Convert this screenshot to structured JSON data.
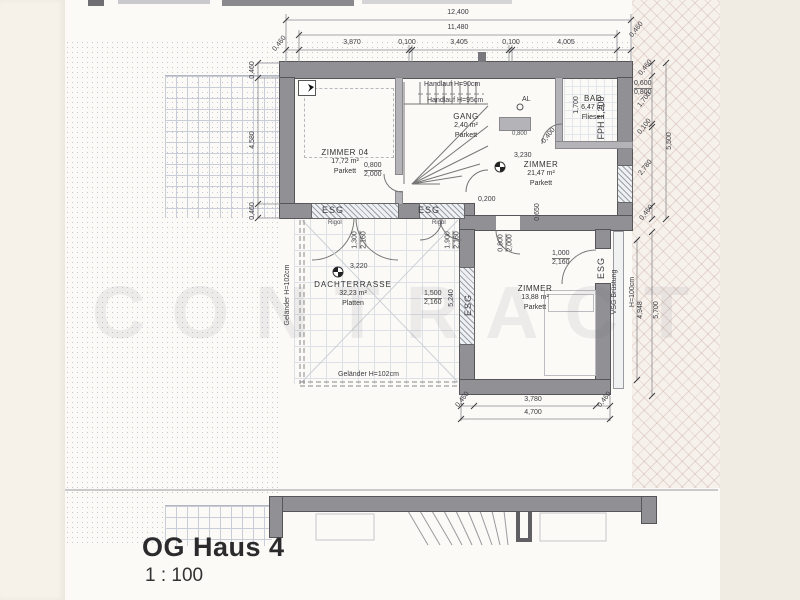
{
  "page": {
    "title": "OG Haus 4",
    "scale": "1 : 100"
  },
  "watermark": "CONTRACT",
  "rooms": {
    "zimmer04": {
      "name": "ZIMMER 04",
      "area": "17,72 m²",
      "floor": "Parkett"
    },
    "gang": {
      "name": "GANG",
      "area": "2,40 m²",
      "floor": "Parkett"
    },
    "bad": {
      "name": "BAD",
      "area": "6,47 m²",
      "floor": "Fliesen"
    },
    "zimmer_og": {
      "name": "ZIMMER",
      "area": "21,47 m²",
      "floor": "Parkett",
      "level": "3,230"
    },
    "zimmer_sued": {
      "name": "ZIMMER",
      "area": "13,88 m²",
      "floor": "Parkett"
    },
    "dachterrasse": {
      "name": "DACHTERRASSE",
      "area": "32,23 m²",
      "floor": "Platten",
      "level": "3,220"
    }
  },
  "stairs": {
    "handlauf_1": "Handlauf H=90cm",
    "handlauf_2": "Handlauf H=95cm"
  },
  "railings": {
    "gelaender_left": "Geländer H=102cm",
    "gelaender_bottom": "Geländer H=102cm",
    "vsg_line1": "VSG Brüstung",
    "vsg_line2": "H=100cm",
    "fph": "FPH 1,200"
  },
  "glass": {
    "esg": [
      "ESG",
      "ESG",
      "ESG",
      "ESG"
    ],
    "rigol": [
      "Rigol",
      "Rigol"
    ],
    "al": "AL"
  },
  "openings": {
    "door_zimmer04": {
      "w": "0,800",
      "h": "2,000"
    },
    "door_zimmer_sued": {
      "w": "0,800",
      "h": "2,000"
    },
    "door_balkon": {
      "w": "1,000",
      "h": "2,160"
    },
    "fenster_terrasse_1": {
      "w": "1,300",
      "h": "2,160"
    },
    "fenster_terrasse_2": {
      "w": "1,900",
      "h": "2,160"
    },
    "fenster_terrasse_3": {
      "w": "1,500",
      "h": "2,160"
    },
    "fenster_bad": {
      "w": "0,600",
      "h": "0,800"
    }
  },
  "dimensions": {
    "top_total": "12,400",
    "top_inner": "11,480",
    "top_segments": [
      "0,460",
      "3,870",
      "0,100",
      "3,405",
      "0,100",
      "4,005",
      "0,460"
    ],
    "left_segments": [
      "0,460",
      "4,580",
      "0,460"
    ],
    "right_segments": [
      "0,460",
      "1,700",
      "0,100",
      "2,780",
      "0,460"
    ],
    "right_total": "5,500",
    "right_lower_outer": "5,700",
    "right_lower_inner": "4,948",
    "bottom_segments": [
      "0,460",
      "3,780",
      "0,460"
    ],
    "bottom_total": "4,700",
    "terrasse_breite": "5,240",
    "bad_tiefe": "1,700",
    "kl_0200": "0,200",
    "kl_0650": "0,650",
    "kl_0400": "0,400",
    "kl_0800": "0,800"
  }
}
